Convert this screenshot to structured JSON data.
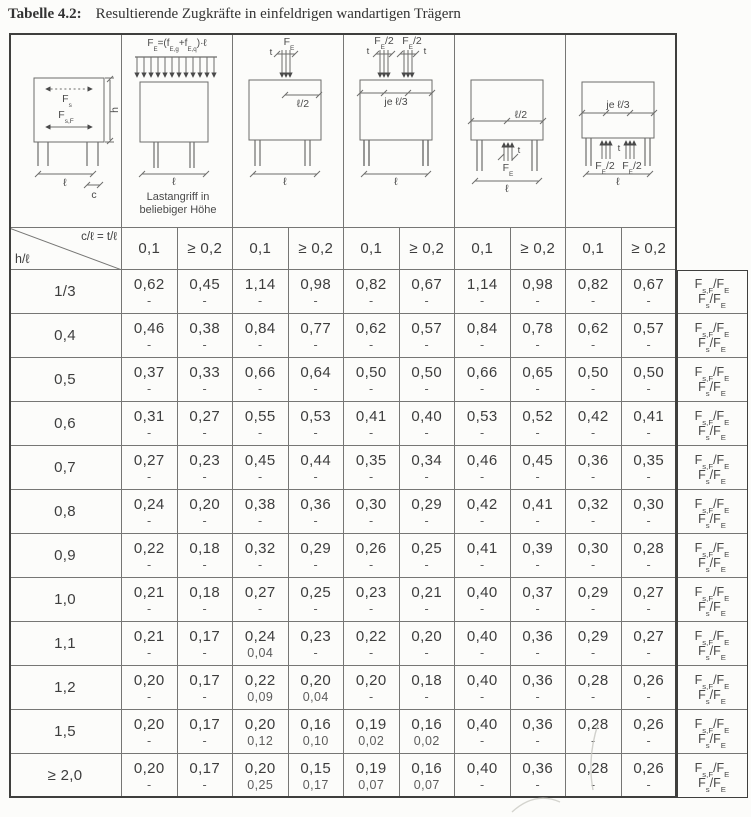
{
  "title": {
    "label": "Tabelle 4.2:",
    "text": "Resultierende Zugkräfte in einfeldrigen wandartigen Trägern"
  },
  "colors": {
    "paper": "#fcfcfa",
    "ink": "#3d3d3d",
    "grid_line": "#767674",
    "frame": "#3f3f3d"
  },
  "header": {
    "corner_top": "c/ℓ = t/ℓ",
    "corner_bottom": "h/ℓ",
    "col_headers": [
      "0,1",
      "≥ 0,2",
      "0,1",
      "≥ 0,2",
      "0,1",
      "≥ 0,2",
      "0,1",
      "≥ 0,2",
      "0,1",
      "≥ 0,2"
    ]
  },
  "diagrams": {
    "legend": {
      "fs": "F~s~",
      "fsf": "F~s,F~",
      "h": "h",
      "l": "ℓ",
      "c": "c"
    },
    "uniform_top": {
      "formula": "F~E~=(f~E,g~+f~E,q~)·ℓ",
      "l": "ℓ",
      "caption1": "Lastangriff in",
      "caption2": "beliebiger Höhe"
    },
    "point_top_center": {
      "force": "F~E~",
      "t": "t",
      "dim": "ℓ/2",
      "l": "ℓ"
    },
    "point_top_thirds": {
      "force1": "F~E~/2",
      "force2": "F~E~/2",
      "t1": "t",
      "t2": "t",
      "dim": "je ℓ/3",
      "l": "ℓ"
    },
    "point_bottom_center": {
      "force": "F~E~",
      "t": "t",
      "dim": "ℓ/2",
      "l": "ℓ"
    },
    "point_bottom_thirds": {
      "force1": "F~E~/2",
      "force2": "F~E~/2",
      "t": "t",
      "dim": "je ℓ/3",
      "l": "ℓ"
    }
  },
  "row_formula": {
    "line1": "F~s,F~/F~E~",
    "line2": "F~s~/F~E~"
  },
  "table": {
    "rows": [
      {
        "h_l": "1/3",
        "cells": [
          [
            "0,62",
            "-"
          ],
          [
            "0,45",
            "-"
          ],
          [
            "1,14",
            "-"
          ],
          [
            "0,98",
            "-"
          ],
          [
            "0,82",
            "-"
          ],
          [
            "0,67",
            "-"
          ],
          [
            "1,14",
            "-"
          ],
          [
            "0,98",
            "-"
          ],
          [
            "0,82",
            "-"
          ],
          [
            "0,67",
            "-"
          ]
        ]
      },
      {
        "h_l": "0,4",
        "cells": [
          [
            "0,46",
            "-"
          ],
          [
            "0,38",
            "-"
          ],
          [
            "0,84",
            "-"
          ],
          [
            "0,77",
            "-"
          ],
          [
            "0,62",
            "-"
          ],
          [
            "0,57",
            "-"
          ],
          [
            "0,84",
            "-"
          ],
          [
            "0,78",
            "-"
          ],
          [
            "0,62",
            "-"
          ],
          [
            "0,57",
            "-"
          ]
        ]
      },
      {
        "h_l": "0,5",
        "cells": [
          [
            "0,37",
            "-"
          ],
          [
            "0,33",
            "-"
          ],
          [
            "0,66",
            "-"
          ],
          [
            "0,64",
            "-"
          ],
          [
            "0,50",
            "-"
          ],
          [
            "0,50",
            "-"
          ],
          [
            "0,66",
            "-"
          ],
          [
            "0,65",
            "-"
          ],
          [
            "0,50",
            "-"
          ],
          [
            "0,50",
            "-"
          ]
        ]
      },
      {
        "h_l": "0,6",
        "cells": [
          [
            "0,31",
            "-"
          ],
          [
            "0,27",
            "-"
          ],
          [
            "0,55",
            "-"
          ],
          [
            "0,53",
            "-"
          ],
          [
            "0,41",
            "-"
          ],
          [
            "0,40",
            "-"
          ],
          [
            "0,53",
            "-"
          ],
          [
            "0,52",
            "-"
          ],
          [
            "0,42",
            "-"
          ],
          [
            "0,41",
            "-"
          ]
        ]
      },
      {
        "h_l": "0,7",
        "cells": [
          [
            "0,27",
            "-"
          ],
          [
            "0,23",
            "-"
          ],
          [
            "0,45",
            "-"
          ],
          [
            "0,44",
            "-"
          ],
          [
            "0,35",
            "-"
          ],
          [
            "0,34",
            "-"
          ],
          [
            "0,46",
            "-"
          ],
          [
            "0,45",
            "-"
          ],
          [
            "0,36",
            "-"
          ],
          [
            "0,35",
            "-"
          ]
        ]
      },
      {
        "h_l": "0,8",
        "cells": [
          [
            "0,24",
            "-"
          ],
          [
            "0,20",
            "-"
          ],
          [
            "0,38",
            "-"
          ],
          [
            "0,36",
            "-"
          ],
          [
            "0,30",
            "-"
          ],
          [
            "0,29",
            "-"
          ],
          [
            "0,42",
            "-"
          ],
          [
            "0,41",
            "-"
          ],
          [
            "0,32",
            "-"
          ],
          [
            "0,30",
            "-"
          ]
        ]
      },
      {
        "h_l": "0,9",
        "cells": [
          [
            "0,22",
            "-"
          ],
          [
            "0,18",
            "-"
          ],
          [
            "0,32",
            "-"
          ],
          [
            "0,29",
            "-"
          ],
          [
            "0,26",
            "-"
          ],
          [
            "0,25",
            "-"
          ],
          [
            "0,41",
            "-"
          ],
          [
            "0,39",
            "-"
          ],
          [
            "0,30",
            "-"
          ],
          [
            "0,28",
            "-"
          ]
        ]
      },
      {
        "h_l": "1,0",
        "cells": [
          [
            "0,21",
            "-"
          ],
          [
            "0,18",
            "-"
          ],
          [
            "0,27",
            "-"
          ],
          [
            "0,25",
            "-"
          ],
          [
            "0,23",
            "-"
          ],
          [
            "0,21",
            "-"
          ],
          [
            "0,40",
            "-"
          ],
          [
            "0,37",
            "-"
          ],
          [
            "0,29",
            "-"
          ],
          [
            "0,27",
            "-"
          ]
        ]
      },
      {
        "h_l": "1,1",
        "cells": [
          [
            "0,21",
            "-"
          ],
          [
            "0,17",
            "-"
          ],
          [
            "0,24",
            "0,04"
          ],
          [
            "0,23",
            "-"
          ],
          [
            "0,22",
            "-"
          ],
          [
            "0,20",
            "-"
          ],
          [
            "0,40",
            "-"
          ],
          [
            "0,36",
            "-"
          ],
          [
            "0,29",
            "-"
          ],
          [
            "0,27",
            "-"
          ]
        ]
      },
      {
        "h_l": "1,2",
        "cells": [
          [
            "0,20",
            "-"
          ],
          [
            "0,17",
            "-"
          ],
          [
            "0,22",
            "0,09"
          ],
          [
            "0,20",
            "0,04"
          ],
          [
            "0,20",
            "-"
          ],
          [
            "0,18",
            "-"
          ],
          [
            "0,40",
            "-"
          ],
          [
            "0,36",
            "-"
          ],
          [
            "0,28",
            "-"
          ],
          [
            "0,26",
            "-"
          ]
        ]
      },
      {
        "h_l": "1,5",
        "cells": [
          [
            "0,20",
            "-"
          ],
          [
            "0,17",
            "-"
          ],
          [
            "0,20",
            "0,12"
          ],
          [
            "0,16",
            "0,10"
          ],
          [
            "0,19",
            "0,02"
          ],
          [
            "0,16",
            "0,02"
          ],
          [
            "0,40",
            "-"
          ],
          [
            "0,36",
            "-"
          ],
          [
            "0,28",
            "-"
          ],
          [
            "0,26",
            "-"
          ]
        ]
      },
      {
        "h_l": "≥ 2,0",
        "cells": [
          [
            "0,20",
            "-"
          ],
          [
            "0,17",
            "-"
          ],
          [
            "0,20",
            "0,25"
          ],
          [
            "0,15",
            "0,17"
          ],
          [
            "0,19",
            "0,07"
          ],
          [
            "0,16",
            "0,07"
          ],
          [
            "0,40",
            "-"
          ],
          [
            "0,36",
            "-"
          ],
          [
            "0,28",
            "-"
          ],
          [
            "0,26",
            "-"
          ]
        ]
      }
    ]
  }
}
